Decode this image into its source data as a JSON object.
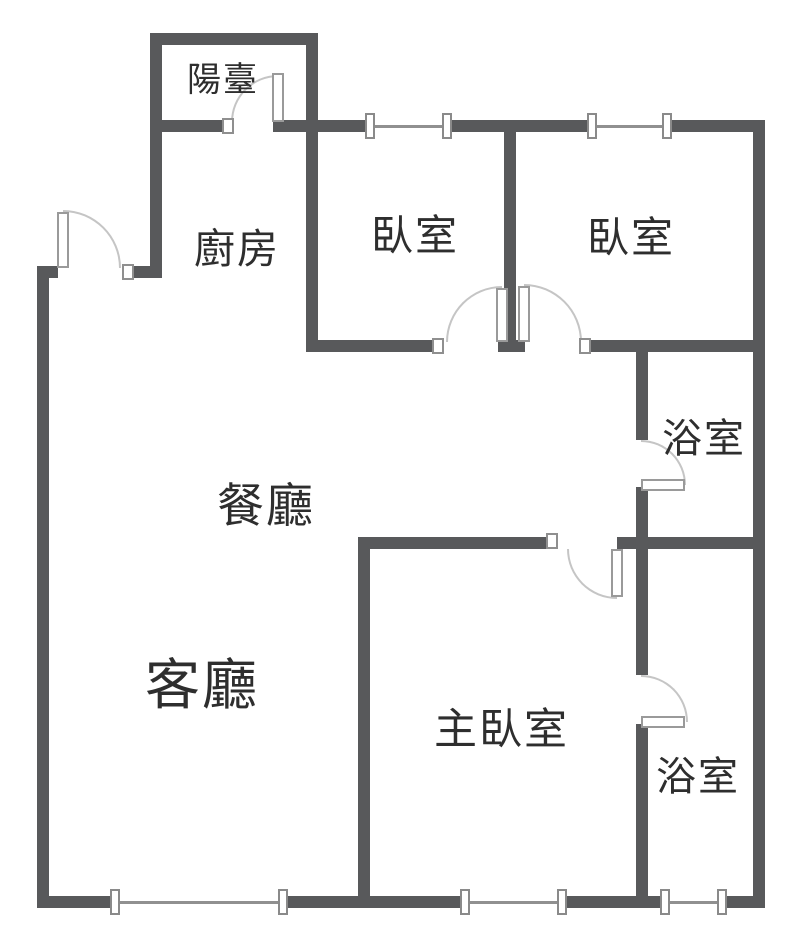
{
  "meta": {
    "type": "apartment-floor-plan",
    "width_px": 800,
    "height_px": 945
  },
  "colors": {
    "wall": "#58595B",
    "door_arc": "#C5C5C5",
    "window_line": "#909090",
    "text": "#2E2E2E",
    "background": "#FFFFFF"
  },
  "rooms": {
    "balcony": {
      "label": "陽臺"
    },
    "kitchen": {
      "label": "廚房"
    },
    "bedroom1": {
      "label": "臥室"
    },
    "bedroom2": {
      "label": "臥室"
    },
    "bath_upper": {
      "label": "浴室"
    },
    "dining": {
      "label": "餐廳"
    },
    "living": {
      "label": "客廳"
    },
    "master_bedroom": {
      "label": "主臥室"
    },
    "bath_lower": {
      "label": "浴室"
    }
  }
}
